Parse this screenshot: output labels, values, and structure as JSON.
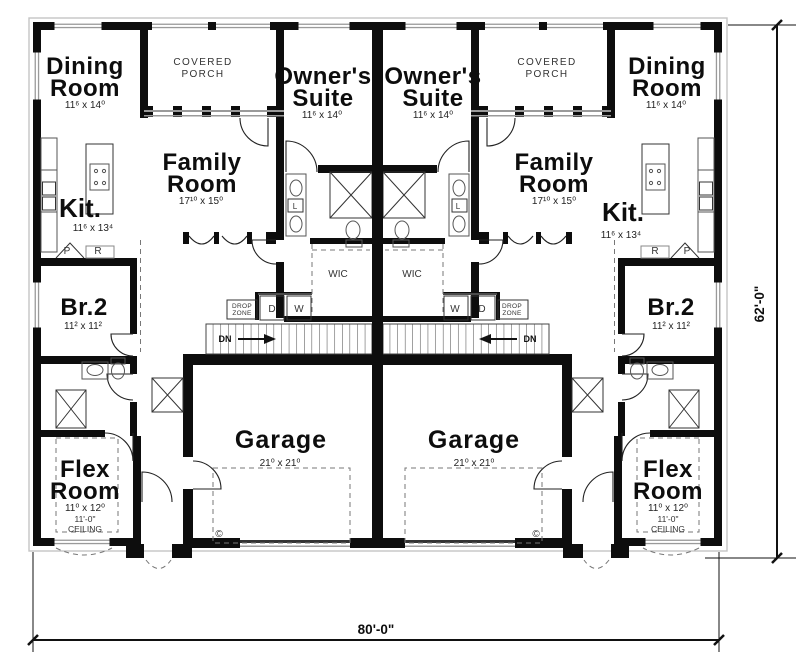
{
  "plan": {
    "type": "duplex-floor-plan",
    "units": 2,
    "mirrored": true
  },
  "labels": {
    "dining": {
      "l1": "Dining",
      "l2": "Room",
      "dims": "11⁶ x 14⁰"
    },
    "porch": {
      "l1": "COVERED",
      "l2": "PORCH"
    },
    "owners": {
      "l1": "Owner's",
      "l2": "Suite",
      "dims": "11⁶ x 14⁰"
    },
    "family": {
      "l1": "Family",
      "l2": "Room",
      "dims": "17¹⁰ x 15⁰"
    },
    "kit": {
      "l1": "Kit.",
      "dims": "11⁶ x 13⁴"
    },
    "br2": {
      "l1": "Br.2",
      "dims": "11² x 11²"
    },
    "flex": {
      "l1": "Flex",
      "l2": "Room",
      "dims": "11⁰ x 12⁰",
      "ceil1": "11'-0\"",
      "ceil2": "CEILING"
    },
    "garage": {
      "l1": "Garage",
      "dims": "21⁰ x 21⁰"
    },
    "wic": "WIC",
    "drop1": "DROP",
    "drop2": "ZONE",
    "dryer": "D",
    "washer": "W",
    "down": "DN",
    "pantry": "P",
    "fridge": "R",
    "linen": "L",
    "copyright": "©"
  },
  "dimensions": {
    "overall_width": "80'-0\"",
    "overall_depth": "62'-0\""
  },
  "colors": {
    "wall": "#0d0d0d",
    "thin_line": "#333333",
    "fixture_line": "#777777",
    "window_gray": "#9a9a9a",
    "background": "#ffffff"
  }
}
